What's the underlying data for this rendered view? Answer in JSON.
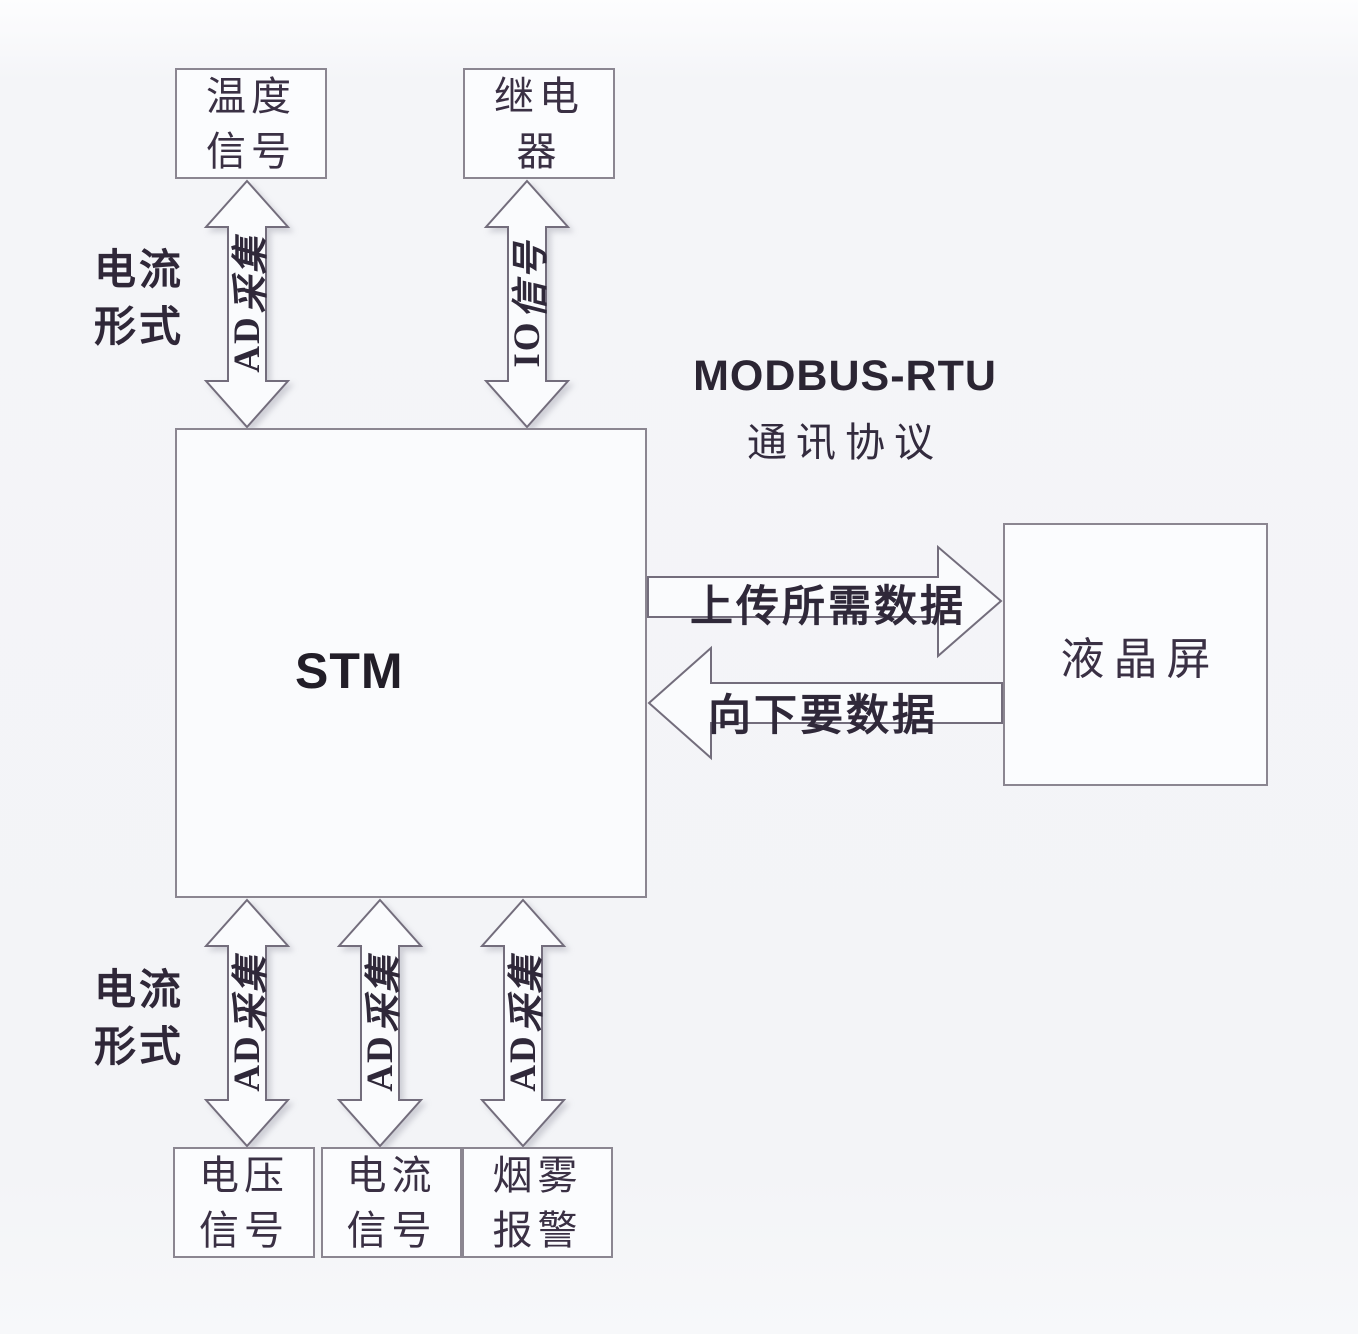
{
  "nodes": {
    "temp": {
      "label": "温度\n信号"
    },
    "relay": {
      "label": "继电\n器"
    },
    "stm": {
      "label": "STM"
    },
    "lcd": {
      "label": "液晶屏"
    },
    "voltage": {
      "label": "电压\n信号"
    },
    "current": {
      "label": "电流\n信号"
    },
    "smoke": {
      "label": "烟雾\n报警"
    }
  },
  "side_labels": {
    "current_form_top": "电流\n形式",
    "current_form_bottom": "电流\n形式"
  },
  "protocol": {
    "line1": "MODBUS-RTU",
    "line2": "通讯协议"
  },
  "arrow_labels": {
    "temp": {
      "latin": "AD",
      "cjk": "采集"
    },
    "relay": {
      "latin": "IO",
      "cjk": "信号"
    },
    "voltage": {
      "latin": "AD",
      "cjk": "采集"
    },
    "current": {
      "latin": "AD",
      "cjk": "采集"
    },
    "smoke": {
      "latin": "AD",
      "cjk": "采集"
    }
  },
  "h_arrow_labels": {
    "upload": "上传所需数据",
    "request": "向下要数据"
  },
  "colors": {
    "background": "#f3f4f7",
    "line": "#736d7c",
    "box_border": "#8b8691",
    "text": "#3a3044"
  }
}
